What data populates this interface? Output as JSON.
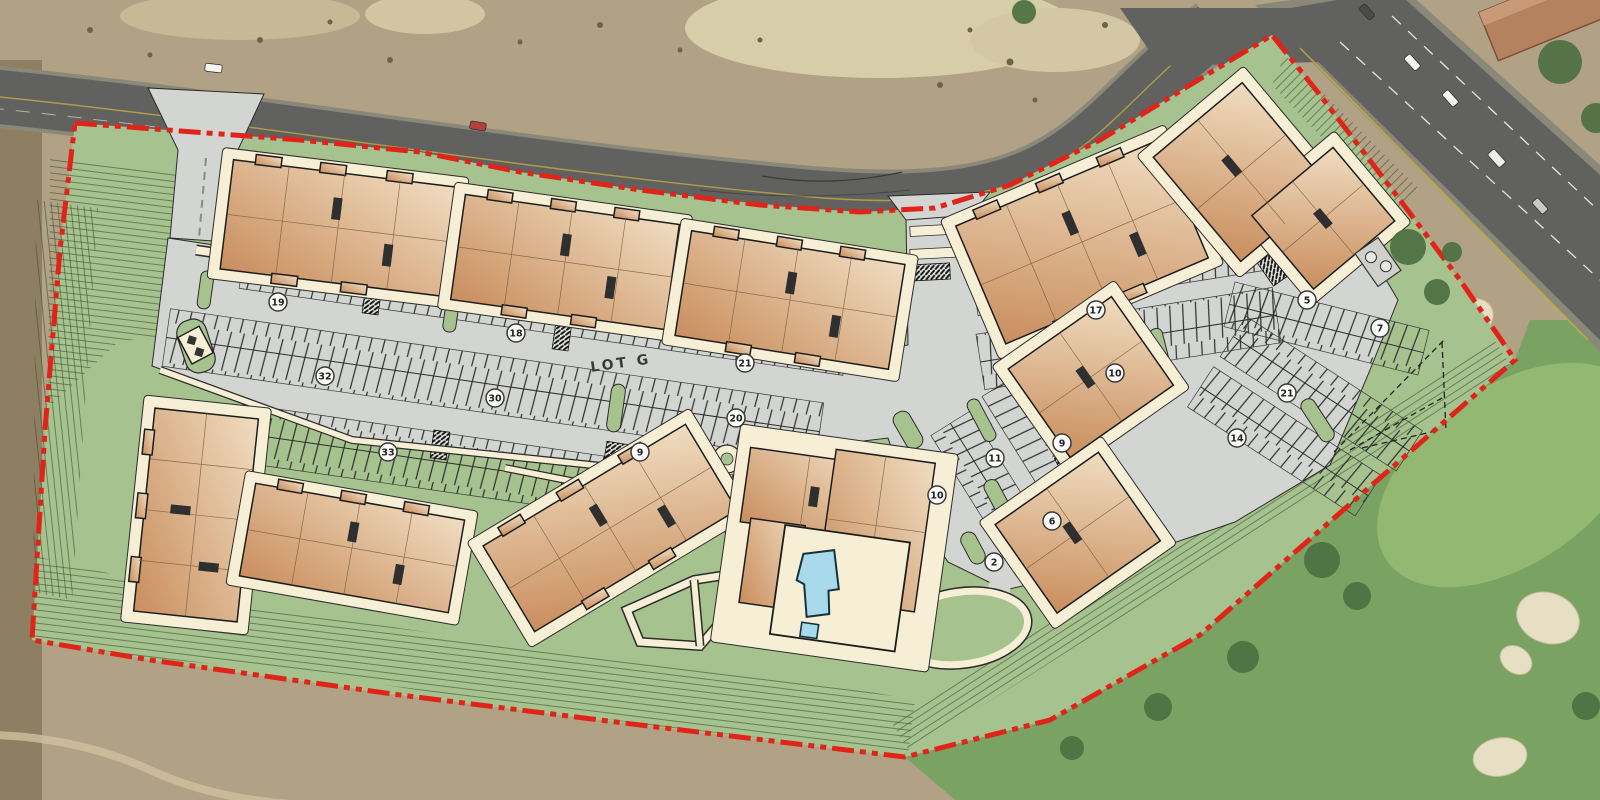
{
  "plan": {
    "boundary_color": "#e0241a",
    "landscape_green": "#a6c28e",
    "parking_gray": "#d3d5d2",
    "walkway_cream": "#f6efd5",
    "building_tan_light": "#f0dcc0",
    "building_tan_dark": "#c98e5e",
    "pool_blue": "#a9daec",
    "road_gray": "#616160",
    "golf_green": "#79a263",
    "desert_tan": "#b2a285"
  },
  "labels": {
    "lot": "LOT G"
  },
  "parking_counts": [
    {
      "value": 19,
      "x": 278,
      "y": 302
    },
    {
      "value": 32,
      "x": 325,
      "y": 376
    },
    {
      "value": 18,
      "x": 516,
      "y": 333
    },
    {
      "value": 30,
      "x": 495,
      "y": 398
    },
    {
      "value": 33,
      "x": 388,
      "y": 452
    },
    {
      "value": 21,
      "x": 745,
      "y": 363
    },
    {
      "value": 20,
      "x": 736,
      "y": 418
    },
    {
      "value": 9,
      "x": 640,
      "y": 452
    },
    {
      "value": 11,
      "x": 995,
      "y": 458
    },
    {
      "value": 10,
      "x": 937,
      "y": 495
    },
    {
      "value": 9,
      "x": 1062,
      "y": 443
    },
    {
      "value": 6,
      "x": 1052,
      "y": 521
    },
    {
      "value": 2,
      "x": 994,
      "y": 562
    },
    {
      "value": 10,
      "x": 1115,
      "y": 373
    },
    {
      "value": 17,
      "x": 1096,
      "y": 310
    },
    {
      "value": 21,
      "x": 1287,
      "y": 393
    },
    {
      "value": 14,
      "x": 1237,
      "y": 438
    },
    {
      "value": 5,
      "x": 1307,
      "y": 300
    },
    {
      "value": 7,
      "x": 1380,
      "y": 328
    }
  ]
}
